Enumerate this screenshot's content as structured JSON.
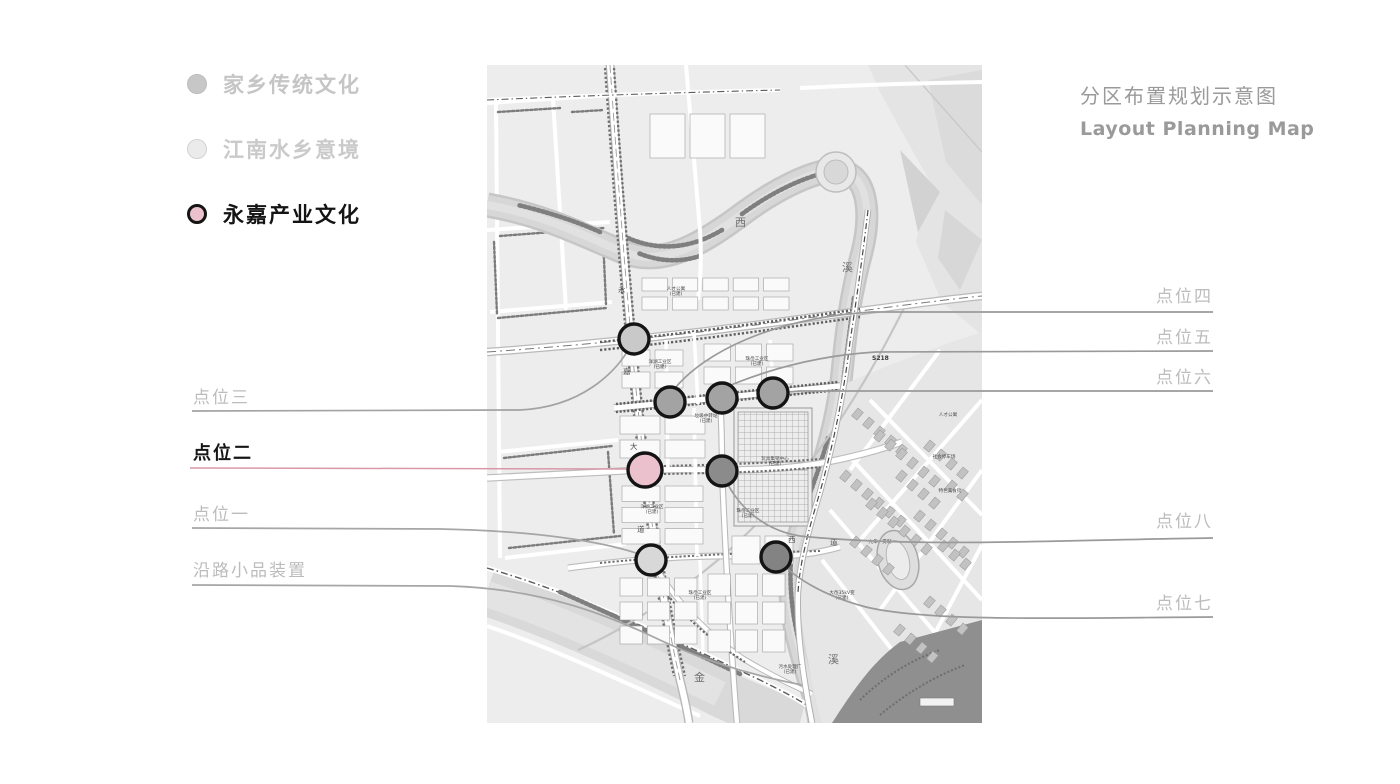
{
  "title": {
    "zh": "分区布置规划示意图",
    "en": "Layout Planning Map",
    "color": "#9a9a9a"
  },
  "legend": {
    "items": [
      {
        "label": "家乡传统文化",
        "fill": "#c7c7c7",
        "ring": "#bdbdbd",
        "text_color": "#c5c5c5",
        "active": false
      },
      {
        "label": "江南水乡意境",
        "fill": "#ebebeb",
        "ring": "#d2d2d2",
        "text_color": "#cacaca",
        "active": false
      },
      {
        "label": "永嘉产业文化",
        "fill": "#eac1cc",
        "ring": "#151515",
        "text_color": "#141414",
        "active": true
      }
    ]
  },
  "annotations": [
    {
      "id": "pt3",
      "label": "点位三",
      "side": "left",
      "text_top": 388,
      "line_color": "#a3a3a3",
      "path": "M192,411 L520,410 C582,407 616,372 630,347",
      "emphasis": false
    },
    {
      "id": "pt2",
      "label": "点位二",
      "side": "left",
      "text_top": 444,
      "line_color": "#d998a9",
      "path": "M190,468 L628,469",
      "emphasis": true
    },
    {
      "id": "pt1",
      "label": "点位一",
      "side": "left",
      "text_top": 505,
      "line_color": "#a6a6a6",
      "path": "M192,528 L440,529 C540,531 602,542 636,553",
      "emphasis": false
    },
    {
      "id": "roadside",
      "label": "沿路小品装置",
      "side": "left",
      "text_top": 561,
      "line_color": "#a6a6a6",
      "path": "M192,585 L450,586 C545,589 610,616 662,641 C714,665 762,677 802,685",
      "emphasis": false
    },
    {
      "id": "pt4",
      "label": "点位四",
      "side": "right",
      "text_top": 287,
      "line_color": "#9a9a9a",
      "path": "M1213,312 L872,312 C770,318 704,354 676,387",
      "emphasis": false
    },
    {
      "id": "pt5",
      "label": "点位五",
      "side": "right",
      "text_top": 328,
      "line_color": "#9a9a9a",
      "path": "M1213,351 L876,352 C808,356 758,374 731,385",
      "emphasis": false
    },
    {
      "id": "pt6",
      "label": "点位六",
      "side": "right",
      "text_top": 368,
      "line_color": "#9a9a9a",
      "path": "M1213,391 L800,391 C792,392 786,392 781,392",
      "emphasis": false
    },
    {
      "id": "pt8",
      "label": "点位八",
      "side": "right",
      "text_top": 512,
      "line_color": "#9a9a9a",
      "path": "M1213,538 C1060,540 918,548 800,536 C756,529 733,497 726,480",
      "emphasis": false
    },
    {
      "id": "pt7",
      "label": "点位七",
      "side": "right",
      "text_top": 594,
      "line_color": "#9a9a9a",
      "path": "M1213,617 C1060,618 928,622 866,607 C820,595 792,575 781,562",
      "emphasis": false
    }
  ],
  "map": {
    "markers": [
      {
        "id": "m1",
        "x": 634,
        "y": 339,
        "r": 15,
        "fill": "#c9c9c9"
      },
      {
        "id": "m2",
        "x": 670,
        "y": 402,
        "r": 15,
        "fill": "#a3a3a3"
      },
      {
        "id": "m3",
        "x": 722,
        "y": 398,
        "r": 15,
        "fill": "#a3a3a3"
      },
      {
        "id": "m4",
        "x": 773,
        "y": 393,
        "r": 15,
        "fill": "#a3a3a3"
      },
      {
        "id": "m5",
        "x": 645,
        "y": 470,
        "r": 17,
        "fill": "#eac1cc"
      },
      {
        "id": "m6",
        "x": 722,
        "y": 471,
        "r": 15,
        "fill": "#8b8b8b"
      },
      {
        "id": "m7",
        "x": 651,
        "y": 560,
        "r": 15,
        "fill": "#d8d8d8"
      },
      {
        "id": "m8",
        "x": 776,
        "y": 557,
        "r": 15,
        "fill": "#838383"
      }
    ],
    "marker_ring": "#141414",
    "labels": [
      {
        "t": "西",
        "x": 735,
        "y": 226,
        "cls": "mt-big"
      },
      {
        "t": "溪",
        "x": 842,
        "y": 271,
        "cls": "mt-big"
      },
      {
        "t": "金",
        "x": 694,
        "y": 681,
        "cls": "mt-big"
      },
      {
        "t": "溪",
        "x": 828,
        "y": 663,
        "cls": "mt-big"
      },
      {
        "t": "永",
        "x": 618,
        "y": 292,
        "cls": "mt-road"
      },
      {
        "t": "嘉",
        "x": 623,
        "y": 374,
        "cls": "mt-road"
      },
      {
        "t": "大",
        "x": 630,
        "y": 449,
        "cls": "mt-road"
      },
      {
        "t": "道",
        "x": 637,
        "y": 532,
        "cls": "mt-road"
      },
      {
        "t": "西",
        "x": 788,
        "y": 542,
        "cls": "mt-road"
      },
      {
        "t": "道",
        "x": 830,
        "y": 545,
        "cls": "mt-road"
      },
      {
        "t": "S218",
        "x": 872,
        "y": 360,
        "cls": "mt-s"
      },
      {
        "t": "人才公寓\n(已建)",
        "x": 676,
        "y": 290,
        "cls": "mt-tiny"
      },
      {
        "t": "洋湖工业区\n(已建)",
        "x": 660,
        "y": 363,
        "cls": "mt-tiny"
      },
      {
        "t": "珠岙工业区\n(已建)",
        "x": 757,
        "y": 360,
        "cls": "mt-tiny"
      },
      {
        "t": "垃圾中转站\n(已建)",
        "x": 706,
        "y": 417,
        "cls": "mt-tiny"
      },
      {
        "t": "玩具集销中心\n(已建)",
        "x": 775,
        "y": 460,
        "cls": "mt-tiny"
      },
      {
        "t": "洋湖工业区\n(已建)",
        "x": 652,
        "y": 508,
        "cls": "mt-tiny"
      },
      {
        "t": "珠岙工业区\n(已建)",
        "x": 748,
        "y": 512,
        "cls": "mt-tiny"
      },
      {
        "t": "珠岙工业区\n(已建)",
        "x": 700,
        "y": 594,
        "cls": "mt-tiny"
      },
      {
        "t": "污水处理厂\n(已建)",
        "x": 790,
        "y": 668,
        "cls": "mt-tiny"
      },
      {
        "t": "大岙35kV变\n(已建)",
        "x": 842,
        "y": 594,
        "cls": "mt-tiny"
      },
      {
        "t": "人才公寓",
        "x": 948,
        "y": 416,
        "cls": "mt-tiny"
      },
      {
        "t": "社会停车场",
        "x": 944,
        "y": 458,
        "cls": "mt-tiny"
      },
      {
        "t": "特色美食街",
        "x": 950,
        "y": 492,
        "cls": "mt-tiny"
      },
      {
        "t": "九年一贯制",
        "x": 880,
        "y": 543,
        "cls": "mt-tiny"
      }
    ]
  }
}
